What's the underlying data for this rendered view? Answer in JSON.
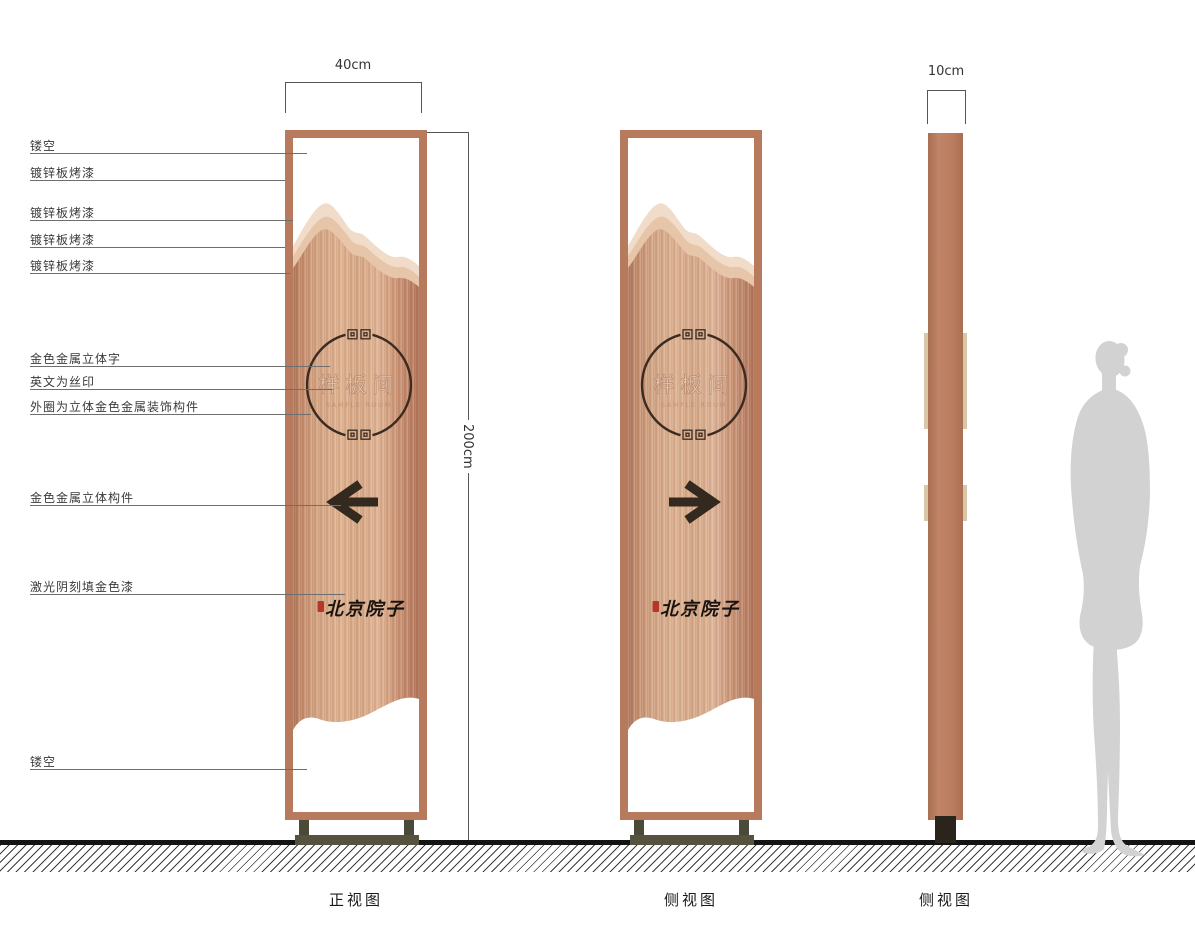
{
  "callouts": {
    "items": [
      {
        "label": "镂空"
      },
      {
        "label": "镀锌板烤漆"
      },
      {
        "label": "镀锌板烤漆"
      },
      {
        "label": "镀锌板烤漆"
      },
      {
        "label": "镀锌板烤漆"
      },
      {
        "label": "金色金属立体字"
      },
      {
        "label": "英文为丝印"
      },
      {
        "label": "外圈为立体金色金属装饰构件"
      },
      {
        "label": "金色金属立体构件"
      },
      {
        "label": "激光阴刻填金色漆"
      },
      {
        "label": "镂空"
      }
    ]
  },
  "dimensions": {
    "front_width": "40cm",
    "height": "200cm",
    "side_depth": "10cm"
  },
  "panel": {
    "title": "样板间",
    "subtitle": "SAMPLE ROOM",
    "brand": "北京院子"
  },
  "captions": {
    "front": "正视图",
    "side": "侧视图",
    "side_profile": "侧视图"
  },
  "colors": {
    "copper_frame": "#b87a5c",
    "mountain_light": "#f0dcc8",
    "mountain_mid": "#e6c5a8",
    "panel_wood": "#d3a07e",
    "circle_stroke": "#3b2b20",
    "arrow": "#33291f",
    "base_olive": "#555340",
    "foot_dark": "#2b241d",
    "seal_red": "#b5372a",
    "silhouette_grey": "#d2d2d2"
  }
}
